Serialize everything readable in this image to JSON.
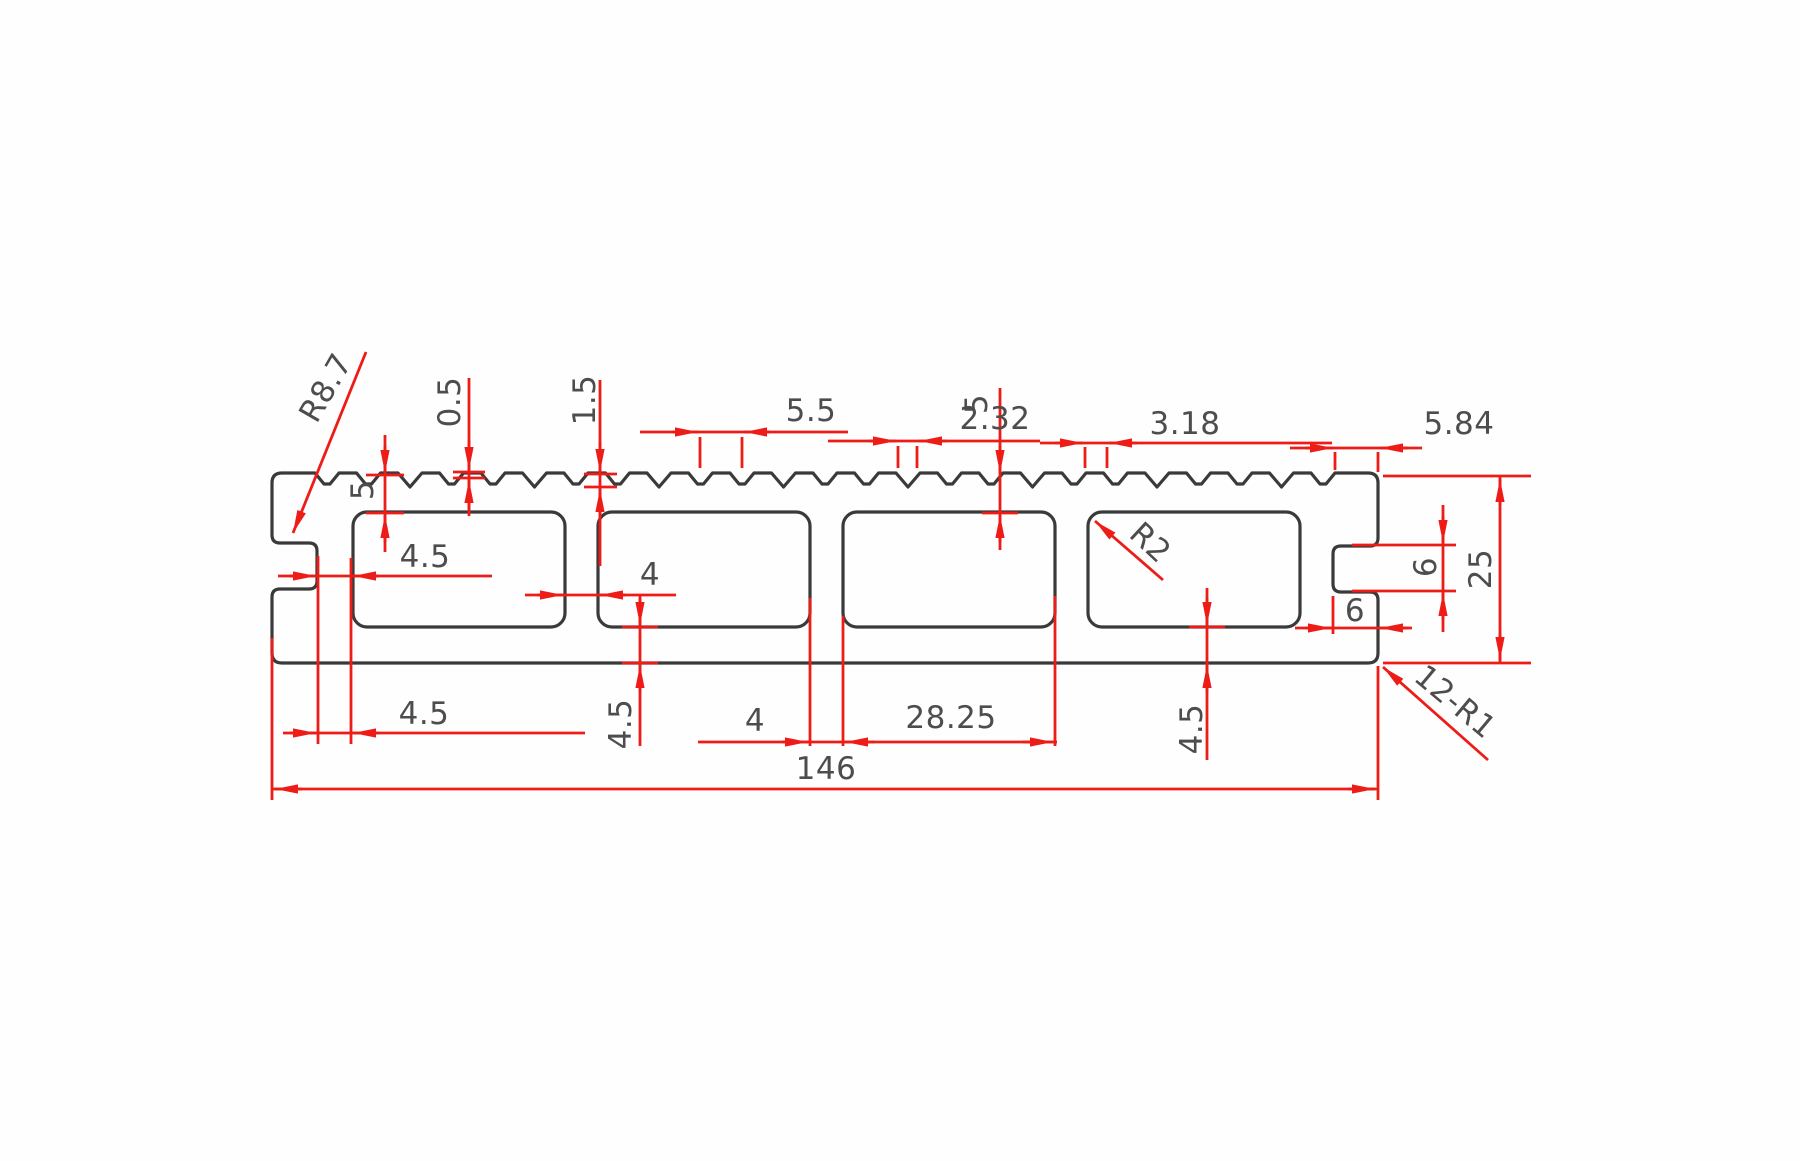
{
  "drawing": {
    "description": "CAD cross-section drawing of a hollow grooved decking board profile with red dimension annotations",
    "colors": {
      "outline": "#3a3a3a",
      "dimension": "#ee1c17",
      "text": "#4d4d4d",
      "background": "#ffffff"
    },
    "labels": {
      "corner_radius_top_left": "R8.7",
      "tooth_minor_depth": "0.5",
      "tooth_major_depth": "1.5",
      "tooth_group_pitch": "5.5",
      "top_wall_center": "5",
      "tooth_pitch_a": "2.32",
      "tooth_pitch_b": "3.18",
      "top_flat_right": "5.84",
      "top_wall_left": "5",
      "web_left_upper": "4.5",
      "web_left_lower": "4.5",
      "web_mid_upper": "4",
      "bottom_wall_center": "4.5",
      "web_mid_lower": "4",
      "chamber_width": "28.25",
      "bottom_wall_right": "4.5",
      "overall_width": "146",
      "edge_groove_depth": "6",
      "edge_groove_height": "6",
      "overall_height": "25",
      "chamber_corner_radius": "R2",
      "fillet_note": "12-R1"
    }
  }
}
